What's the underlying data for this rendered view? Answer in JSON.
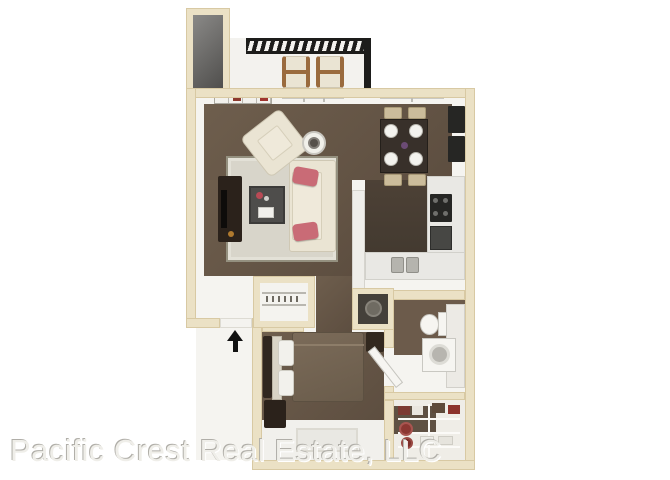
{
  "watermark": {
    "text": "Pacific Crest Real Estate, LLC"
  },
  "entry": {
    "direction": "up"
  },
  "icons": {
    "entry_arrow": "up-arrow"
  },
  "colors": {
    "background": "#ffffff",
    "wall_fill": "#ebe1c5",
    "wall_edge": "#d8c9a3",
    "interior_white": "#f5f4f0",
    "carpet": "#6e5e4d",
    "carpet_dark": "#5d4e40",
    "wood_floor": "#4d4136",
    "rug": "#d8d5ca",
    "rug_border": "#94907f",
    "sofa_cream": "#eae4d3",
    "pillow_pink": "#c96b76",
    "furniture_dark": "#2b221b",
    "railing_black": "#1d1d1b",
    "lounger_wood": "#9a6b3e",
    "counter_white": "#e9e8e4",
    "appliance_black": "#262624",
    "bed_comforter": "#7b6b59",
    "bathroom_floor": "#6c5b4b",
    "watermark_gray": "#b0aea8"
  }
}
